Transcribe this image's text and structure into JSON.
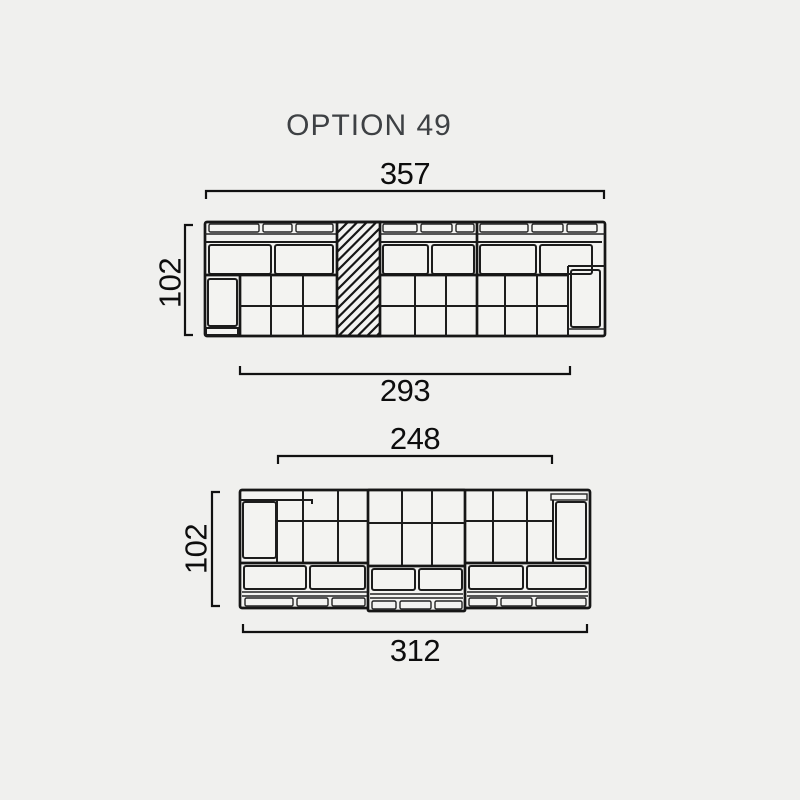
{
  "title": "OPTION 49",
  "colors": {
    "background": "#f0f0ee",
    "line": "#161616",
    "dimension_text": "#0d0d0d",
    "title_text": "#3e4144"
  },
  "top_sofa": {
    "overall_width": "357",
    "depth": "102",
    "seat_width": "293"
  },
  "bottom_sofa": {
    "seat_width": "248",
    "depth": "102",
    "overall_width": "312"
  }
}
